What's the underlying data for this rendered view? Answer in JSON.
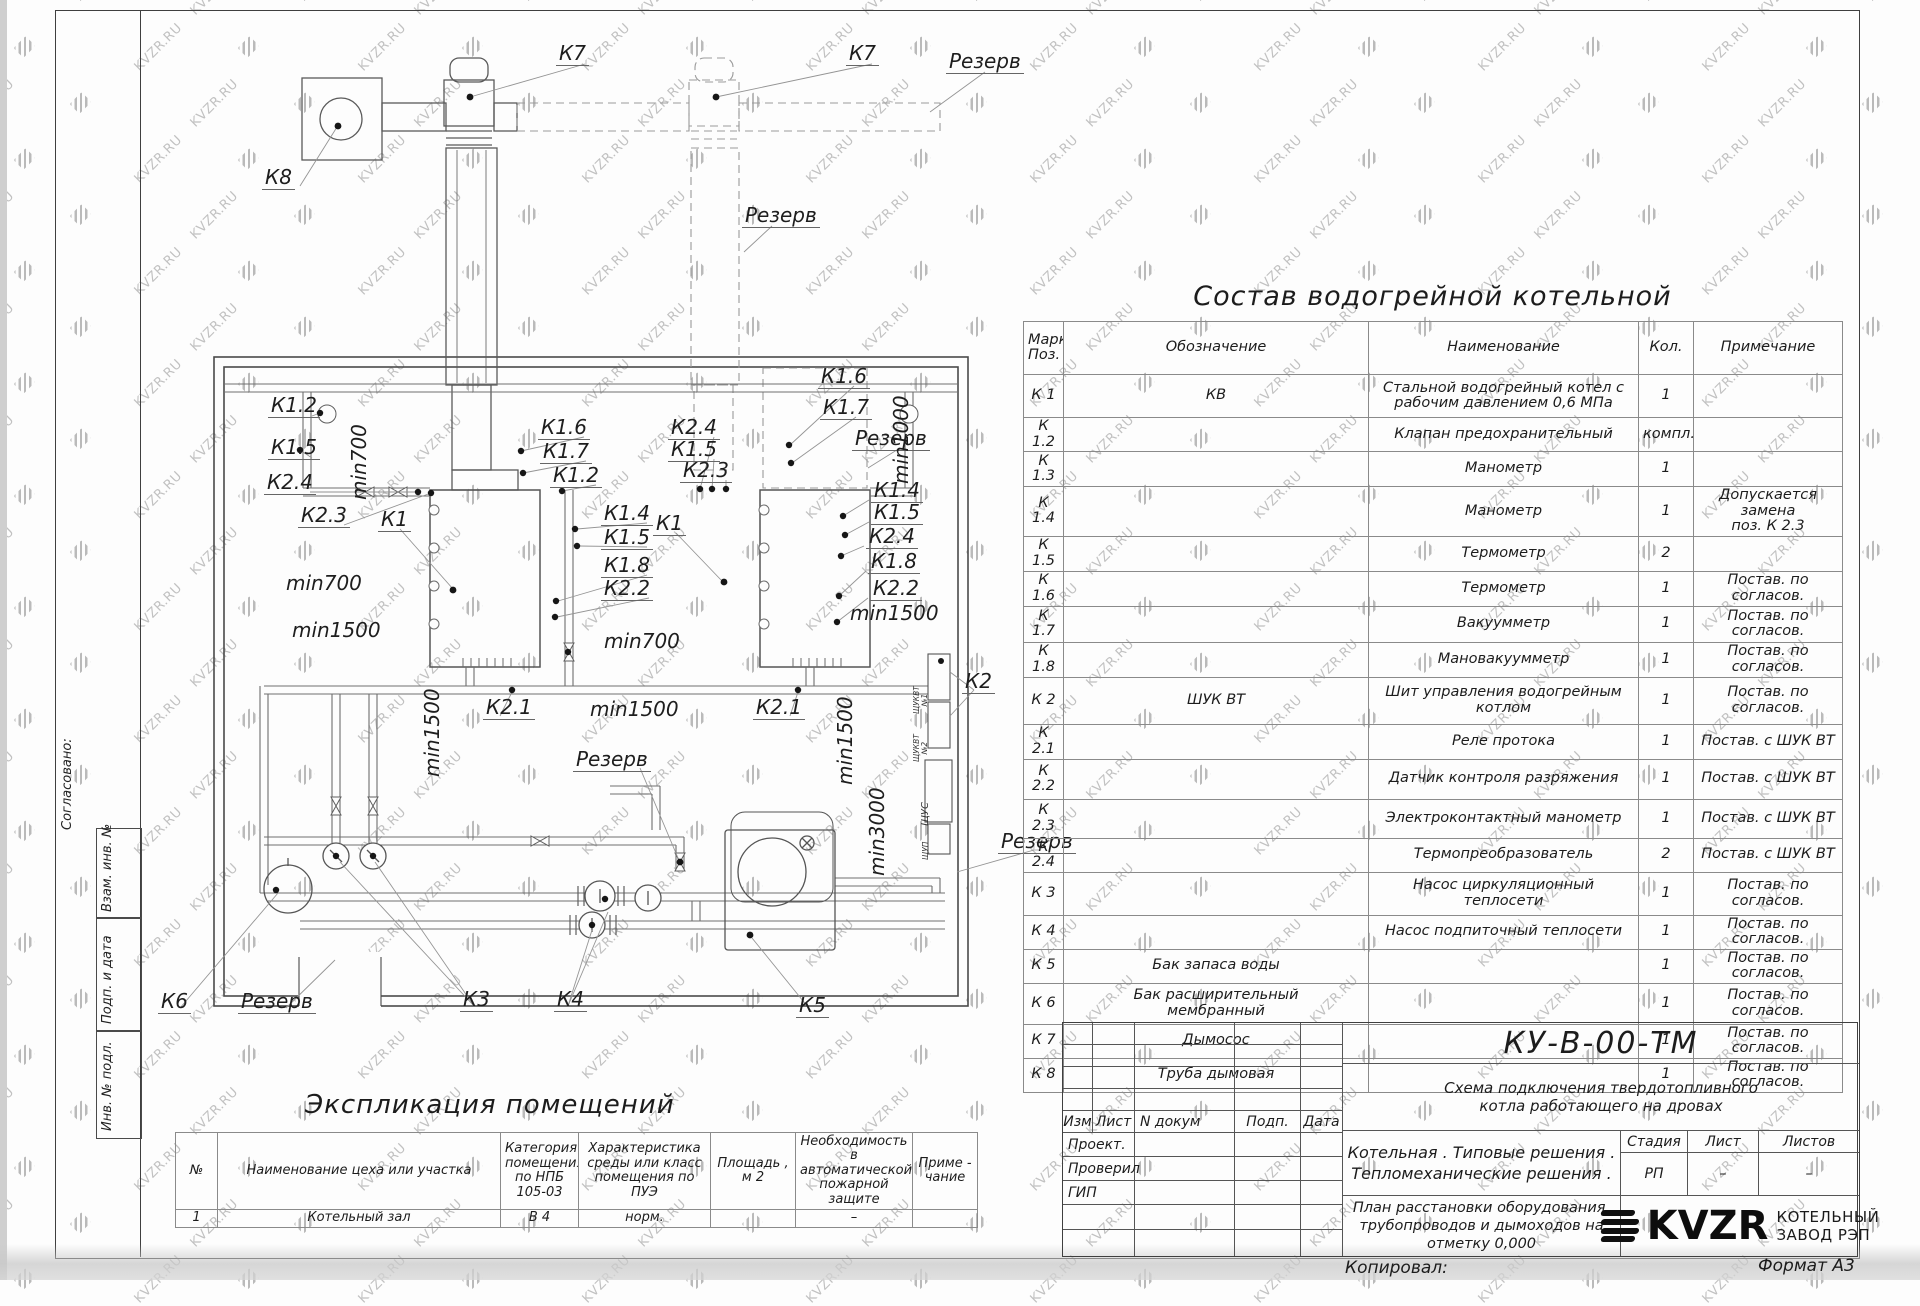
{
  "sheet": {
    "watermark_text": "KVZR.RU",
    "copied_label": "Копировал:",
    "format_label": "Формат А3",
    "side_labels": {
      "agreed": "Согласовано:",
      "vzam": "Взам. инв. №",
      "podp": "Подп. и дата",
      "inv": "Инв. № подл."
    }
  },
  "equipment_table": {
    "title": "Состав водогрейной котельной",
    "headers": [
      "Марка\nПоз.",
      "Обозначение",
      "Наименование",
      "Кол.",
      "Примечание"
    ],
    "col_widths": [
      40,
      305,
      270,
      55,
      149
    ],
    "row_heights": [
      40,
      28,
      32,
      46,
      32,
      32,
      33,
      32,
      44,
      32,
      37,
      36,
      30,
      40,
      23,
      27,
      38,
      28,
      24
    ],
    "rows": [
      [
        "К 1",
        "КВ",
        "Стальной водогрейный котел с\nрабочим давлением 0,6  МПа",
        "1",
        ""
      ],
      [
        "К 1.2",
        "",
        "Клапан предохранительный",
        "компл.",
        ""
      ],
      [
        "К 1.3",
        "",
        "Манометр",
        "1",
        ""
      ],
      [
        "К 1.4",
        "",
        "Манометр",
        "1",
        "Допускается замена\nпоз. К 2.3"
      ],
      [
        "К 1.5",
        "",
        "Термометр",
        "2",
        ""
      ],
      [
        "К 1.6",
        "",
        "Термометр",
        "1",
        "Постав. по согласов."
      ],
      [
        "К 1.7",
        "",
        "Вакуумметр",
        "1",
        "Постав. по согласов."
      ],
      [
        "К 1.8",
        "",
        "Мановакуумметр",
        "1",
        "Постав. по согласов."
      ],
      [
        "К 2",
        "ШУК ВТ",
        "Шит управления водогрейным\nкотлом",
        "1",
        "Постав. по согласов."
      ],
      [
        "К 2.1",
        "",
        "Реле протока",
        "1",
        "Постав. с ШУК ВТ"
      ],
      [
        "К 2.2",
        "",
        "Датчик контроля разряжения",
        "1",
        "Постав. с ШУК ВТ"
      ],
      [
        "К 2.3",
        "",
        "Электроконтактный манометр",
        "1",
        "Постав. с ШУК ВТ"
      ],
      [
        "К 2.4",
        "",
        "Термопреобразователь",
        "2",
        "Постав. с ШУК ВТ"
      ],
      [
        "К 3",
        "",
        "Насос циркуляционный\nтеплосети",
        "1",
        "Постав. по согласов."
      ],
      [
        "К 4",
        "",
        "Насос подпиточный теплосети",
        "1",
        "Постав. по согласов."
      ],
      [
        "К 5",
        "Бак запаса воды",
        "",
        "1",
        "Постав. по согласов."
      ],
      [
        "К 6",
        "Бак расширительный\nмембранный",
        "",
        "1",
        "Постав. по согласов."
      ],
      [
        "К 7",
        "Дымосос",
        "",
        "1",
        "Постав. по согласов."
      ],
      [
        "К 8",
        "Труба дымовая",
        "",
        "1",
        "Постав. по согласов."
      ]
    ]
  },
  "rooms_table": {
    "title": "Экспликация помещений",
    "headers": [
      "№",
      "Наименование цеха или участка",
      "Категория\nпомещения\nпо НПБ\n105-03",
      "Характеристика\nсреды или класс\nпомещения по\nПУЭ",
      "Площадь ,\nм 2",
      "Необходимость в\nавтоматической\nпожарной защите",
      "Приме -\nчание"
    ],
    "col_widths": [
      42,
      283,
      78,
      132,
      85,
      117,
      65
    ],
    "rows": [
      [
        "1",
        "Котельный зал",
        "В 4",
        "норм.",
        "",
        "–",
        ""
      ]
    ]
  },
  "title_block": {
    "doc_code": "КУ-В-00-ТМ",
    "doc_title": "Схема подключения твердотопливного\nкотла работающего на дровах",
    "org_title": "Котельная . Типовые решения .\nТепломеханические решения .",
    "plan_title": "План расстановки оборудования,\nтрубопроводов и дымоходов на\nотметку  0,000",
    "rev_headers": [
      "Изм",
      "Лист",
      "N докум",
      "Подп.",
      "Дата"
    ],
    "roles": [
      "Проект.",
      "Проверил",
      "ГИП"
    ],
    "stage_header": "Стадия",
    "sheet_header": "Лист",
    "sheets_header": "Листов",
    "stage": "РП",
    "sheet": "–",
    "sheets": "–",
    "logo_text": "KVZR",
    "logo_caption": "КОТЕЛЬНЫЙ\nЗАВОД РЭП"
  },
  "drawing": {
    "labels": [
      {
        "t": "К7",
        "x": 556,
        "y": 42,
        "c": "lbl"
      },
      {
        "t": "К7",
        "x": 846,
        "y": 42,
        "c": "lbl"
      },
      {
        "t": "Резерв",
        "x": 946,
        "y": 50,
        "c": "lbl"
      },
      {
        "t": "К8",
        "x": 262,
        "y": 166,
        "c": "lbl"
      },
      {
        "t": "Резерв",
        "x": 742,
        "y": 204,
        "c": "lbl"
      },
      {
        "t": "К1.2",
        "x": 268,
        "y": 394,
        "c": "lbl"
      },
      {
        "t": "К1.5",
        "x": 268,
        "y": 436,
        "c": "lbl"
      },
      {
        "t": "К2.4",
        "x": 264,
        "y": 471,
        "c": "lbl"
      },
      {
        "t": "К2.3",
        "x": 298,
        "y": 504,
        "c": "lbl"
      },
      {
        "t": "К1",
        "x": 378,
        "y": 508,
        "c": "lbl"
      },
      {
        "t": "min700",
        "x": 370,
        "y": 480,
        "c": "dim rot"
      },
      {
        "t": "min700",
        "x": 284,
        "y": 572,
        "c": "dim"
      },
      {
        "t": "min1500",
        "x": 290,
        "y": 619,
        "c": "dim"
      },
      {
        "t": "К1.6",
        "x": 538,
        "y": 416,
        "c": "lbl"
      },
      {
        "t": "К1.7",
        "x": 540,
        "y": 440,
        "c": "lbl"
      },
      {
        "t": "К1.2",
        "x": 550,
        "y": 464,
        "c": "lbl"
      },
      {
        "t": "К2.4",
        "x": 668,
        "y": 416,
        "c": "lbl"
      },
      {
        "t": "К1.5",
        "x": 668,
        "y": 438,
        "c": "lbl"
      },
      {
        "t": "К2.3",
        "x": 680,
        "y": 459,
        "c": "lbl"
      },
      {
        "t": "К1.4",
        "x": 601,
        "y": 502,
        "c": "lbl"
      },
      {
        "t": "К1",
        "x": 653,
        "y": 512,
        "c": "lbl"
      },
      {
        "t": "К1.5",
        "x": 601,
        "y": 526,
        "c": "lbl"
      },
      {
        "t": "К1.8",
        "x": 601,
        "y": 554,
        "c": "lbl"
      },
      {
        "t": "К2.2",
        "x": 601,
        "y": 577,
        "c": "lbl"
      },
      {
        "t": "min700",
        "x": 602,
        "y": 630,
        "c": "dim"
      },
      {
        "t": "К1.6",
        "x": 818,
        "y": 365,
        "c": "lbl"
      },
      {
        "t": "К1.7",
        "x": 820,
        "y": 396,
        "c": "lbl"
      },
      {
        "t": "Резерв",
        "x": 852,
        "y": 427,
        "c": "lbl"
      },
      {
        "t": "min1000",
        "x": 912,
        "y": 464,
        "c": "dim rot"
      },
      {
        "t": "К1.4",
        "x": 871,
        "y": 479,
        "c": "lbl"
      },
      {
        "t": "К1.5",
        "x": 871,
        "y": 501,
        "c": "lbl"
      },
      {
        "t": "К2.4",
        "x": 866,
        "y": 525,
        "c": "lbl"
      },
      {
        "t": "К1.8",
        "x": 868,
        "y": 550,
        "c": "lbl"
      },
      {
        "t": "К2.2",
        "x": 870,
        "y": 577,
        "c": "lbl"
      },
      {
        "t": "min1500",
        "x": 848,
        "y": 602,
        "c": "dim"
      },
      {
        "t": "min1500",
        "x": 443,
        "y": 757,
        "c": "dim rot"
      },
      {
        "t": "К2.1",
        "x": 483,
        "y": 696,
        "c": "lbl"
      },
      {
        "t": "min1500",
        "x": 588,
        "y": 698,
        "c": "dim"
      },
      {
        "t": "Резерв",
        "x": 573,
        "y": 748,
        "c": "lbl"
      },
      {
        "t": "К2.1",
        "x": 753,
        "y": 696,
        "c": "lbl"
      },
      {
        "t": "min1500",
        "x": 856,
        "y": 765,
        "c": "dim rot"
      },
      {
        "t": "min3000",
        "x": 888,
        "y": 856,
        "c": "dim rot"
      },
      {
        "t": "К2",
        "x": 962,
        "y": 670,
        "c": "lbl"
      },
      {
        "t": "Резерв",
        "x": 998,
        "y": 830,
        "c": "lbl"
      },
      {
        "t": "К6",
        "x": 158,
        "y": 990,
        "c": "lbl"
      },
      {
        "t": "Резерв",
        "x": 238,
        "y": 990,
        "c": "lbl"
      },
      {
        "t": "К3",
        "x": 460,
        "y": 988,
        "c": "lbl"
      },
      {
        "t": "К4",
        "x": 554,
        "y": 988,
        "c": "lbl"
      },
      {
        "t": "К5",
        "x": 796,
        "y": 994,
        "c": "lbl"
      }
    ],
    "panels": [
      {
        "t": "ЩУКВТ\n№1",
        "x": 929,
        "y": 698,
        "c": "panel-t"
      },
      {
        "t": "ЩУКВТ\n№2",
        "x": 929,
        "y": 746,
        "c": "panel-t"
      },
      {
        "t": "ЩУС",
        "x": 930,
        "y": 818,
        "c": "panel-t big"
      },
      {
        "t": "ЩУП",
        "x": 930,
        "y": 852,
        "c": "panel-t"
      }
    ]
  }
}
